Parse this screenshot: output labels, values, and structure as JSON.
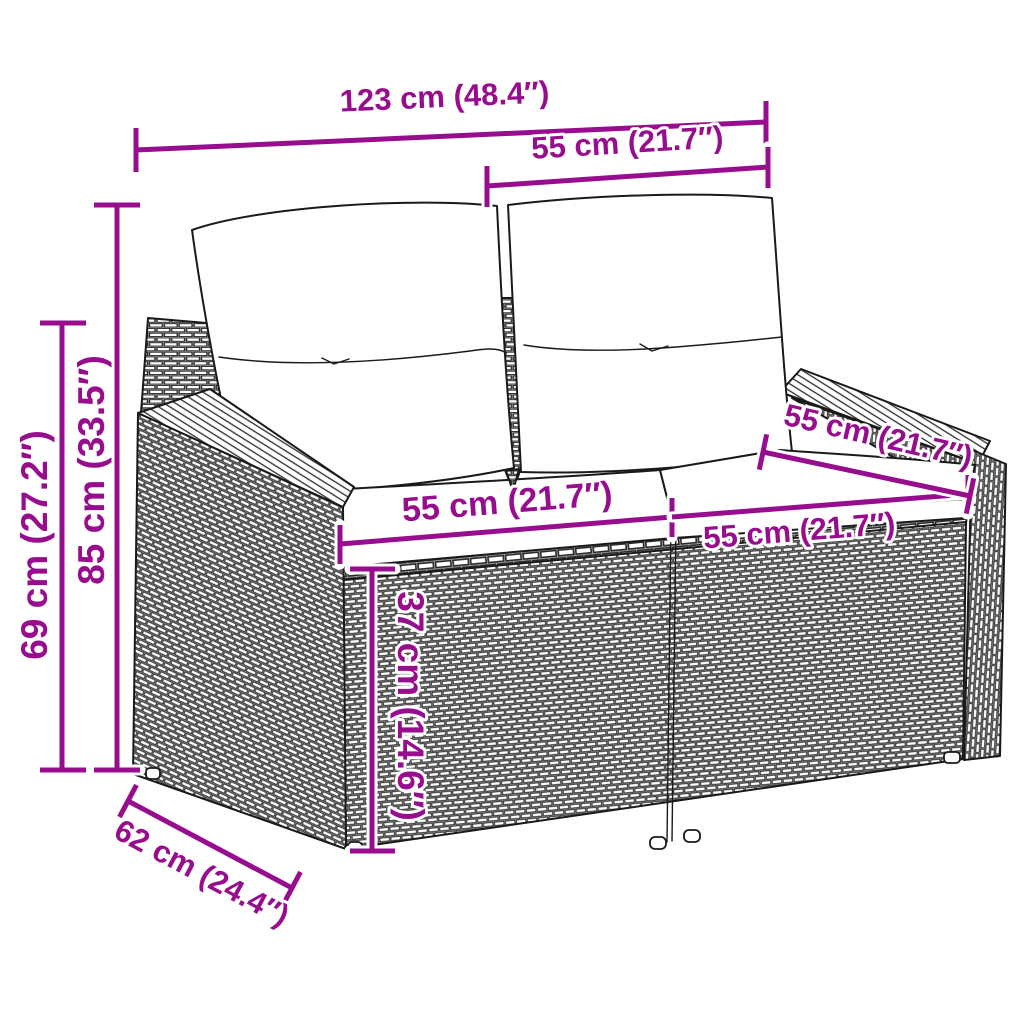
{
  "diagram": {
    "type": "product-dimension-diagram",
    "product": "rattan-garden-loveseat-with-cushions",
    "colors": {
      "accent": "#970D8E",
      "outline": "#1A1A1A",
      "background": "#FFFFFF",
      "cushion_fill": "#FFFFFF"
    },
    "dimensions": {
      "overall_width": "123 cm (48.4″)",
      "backrest_width": "55 cm (21.7″)",
      "overall_height": "85 cm (33.5″)",
      "armrest_height": "69 cm (27.2″)",
      "seat_width_left": "55 cm (21.7″)",
      "seat_width_right": "55 cm (21.7″)",
      "seat_depth": "55 cm (21.7″)",
      "seat_height": "37 cm (14.6″)",
      "base_depth": "62 cm (24.4″)"
    }
  }
}
